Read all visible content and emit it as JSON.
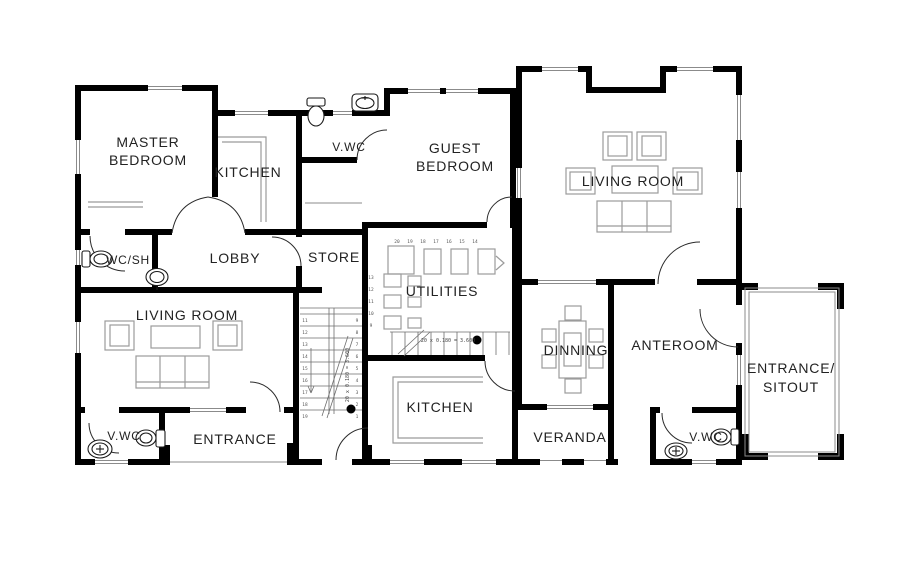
{
  "plan": {
    "rooms": {
      "master_bedroom": {
        "line1": "MASTER",
        "line2": "BEDROOM"
      },
      "kitchen_top": {
        "label": "KITCHEN"
      },
      "vwc_top": {
        "label": "V.WC"
      },
      "guest_bedroom": {
        "line1": "GUEST",
        "line2": "BEDROOM"
      },
      "living_room_upper": {
        "label": "LIVING ROOM"
      },
      "wc_sh": {
        "label": "WC/SH"
      },
      "lobby": {
        "label": "LOBBY"
      },
      "store": {
        "label": "STORE"
      },
      "utilities": {
        "label": "UTILITIES"
      },
      "living_room_lower": {
        "label": "LIVING ROOM"
      },
      "vwc_lower_left": {
        "label": "V.WC"
      },
      "entrance": {
        "label": "ENTRANCE"
      },
      "kitchen_lower": {
        "label": "KITCHEN"
      },
      "veranda": {
        "label": "VERANDA"
      },
      "dinning": {
        "label": "DINNING"
      },
      "anteroom": {
        "label": "ANTEROOM"
      },
      "vwc_lower_right": {
        "label": "V.WC"
      },
      "entrance_sitout": {
        "line1": "ENTRANCE/",
        "line2": "SITOUT"
      }
    },
    "stairs": {
      "corridor": {
        "left_numbers": [
          "11",
          "12",
          "13",
          "14",
          "15",
          "16",
          "17",
          "18",
          "19"
        ],
        "right_numbers": [
          "9",
          "8",
          "7",
          "6",
          "5",
          "4",
          "3",
          "2",
          "1"
        ],
        "note": "20 x 0.180 = 3.600"
      },
      "utilities": {
        "top_numbers": [
          "20",
          "19",
          "18",
          "17",
          "16",
          "15",
          "14"
        ],
        "side_numbers": [
          "13",
          "12",
          "11",
          "10",
          "9"
        ],
        "note": "20 x 0.180 = 3.600"
      }
    },
    "colors": {
      "wall": "#000000",
      "thin_line": "#8b8b8b",
      "furniture_line": "#9b9b9b",
      "text": "#222222",
      "background": "#ffffff"
    }
  }
}
